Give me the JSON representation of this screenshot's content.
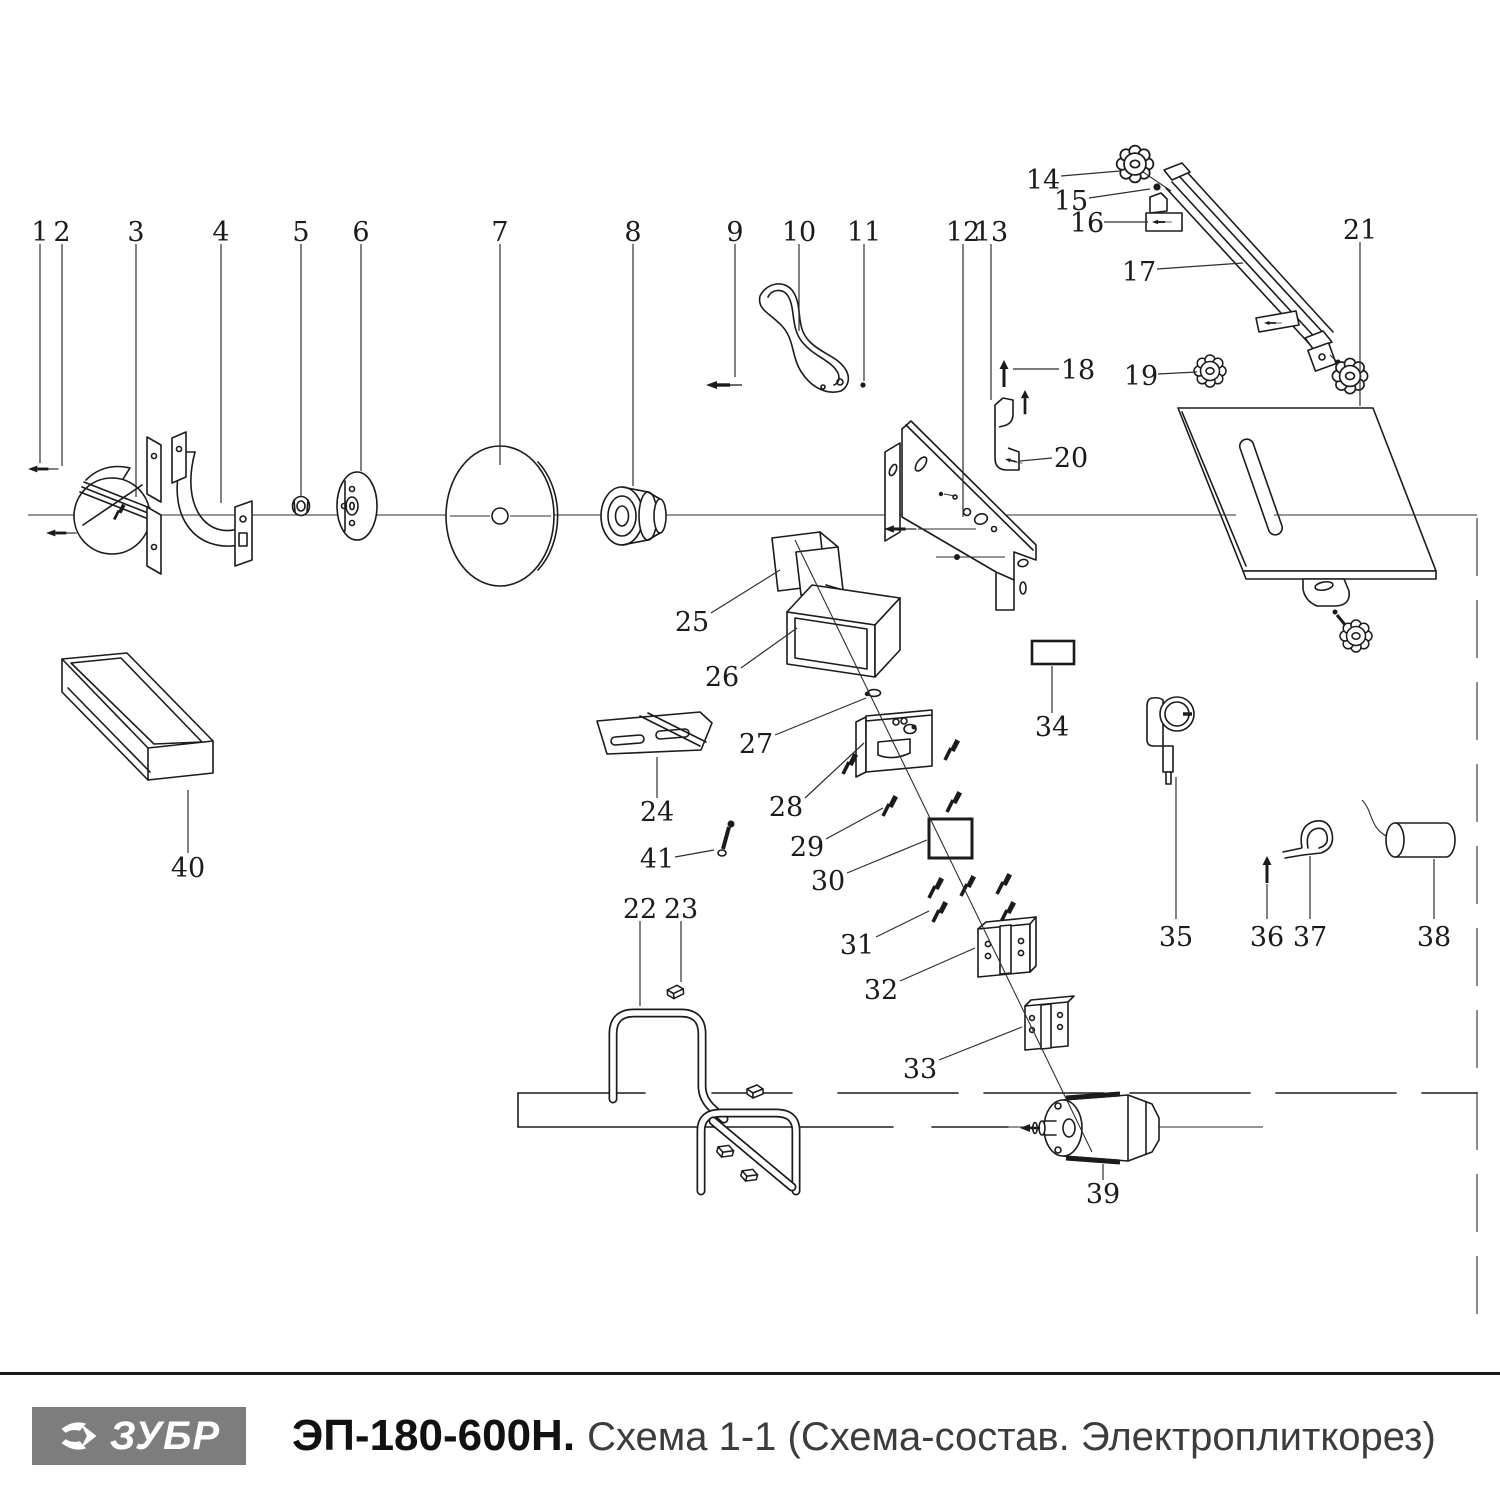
{
  "footer": {
    "logo": {
      "text": "ЗУБР",
      "bg": "#7d7d7d",
      "fg": "#ffffff"
    },
    "model": "ЭП-180-600Н.",
    "subtitle": "Схема 1-1 (Схема-состав. Электроплиткорез)"
  },
  "diagram": {
    "stroke": "#1b1b1b",
    "callouts": [
      {
        "n": "1",
        "label": [
          40,
          232
        ],
        "line": [
          40,
          244,
          40,
          463
        ]
      },
      {
        "n": "2",
        "label": [
          62,
          232
        ],
        "line": [
          62,
          244,
          62,
          466
        ]
      },
      {
        "n": "3",
        "label": [
          136,
          232
        ],
        "line": [
          136,
          244,
          136,
          497
        ]
      },
      {
        "n": "4",
        "label": [
          221,
          232
        ],
        "line": [
          221,
          244,
          221,
          503
        ]
      },
      {
        "n": "5",
        "label": [
          301,
          232
        ],
        "line": [
          301,
          244,
          301,
          496
        ]
      },
      {
        "n": "6",
        "label": [
          361,
          232
        ],
        "line": [
          361,
          244,
          361,
          471
        ]
      },
      {
        "n": "7",
        "label": [
          500,
          232
        ],
        "line": [
          500,
          244,
          500,
          465
        ]
      },
      {
        "n": "8",
        "label": [
          633,
          232
        ],
        "line": [
          633,
          244,
          633,
          486
        ]
      },
      {
        "n": "9",
        "label": [
          735,
          232
        ],
        "line": [
          735,
          244,
          735,
          377
        ]
      },
      {
        "n": "10",
        "label": [
          799,
          232
        ],
        "line": [
          799,
          244,
          799,
          331
        ]
      },
      {
        "n": "11",
        "label": [
          864,
          232
        ],
        "line": [
          864,
          244,
          864,
          381
        ]
      },
      {
        "n": "12",
        "label": [
          963,
          232
        ],
        "line": [
          963,
          244,
          963,
          517
        ]
      },
      {
        "n": "13",
        "label": [
          991,
          232
        ],
        "line": [
          991,
          244,
          991,
          400
        ]
      },
      {
        "n": "14",
        "label": [
          1043,
          180
        ],
        "line": [
          1061,
          176,
          1120,
          171
        ]
      },
      {
        "n": "15",
        "label": [
          1071,
          201
        ],
        "line": [
          1089,
          198,
          1150,
          189
        ]
      },
      {
        "n": "16",
        "label": [
          1087,
          223
        ],
        "line": [
          1104,
          222,
          1148,
          222
        ]
      },
      {
        "n": "17",
        "label": [
          1139,
          272
        ],
        "line": [
          1157,
          269,
          1243,
          263
        ]
      },
      {
        "n": "18",
        "label": [
          1078,
          370
        ],
        "line": [
          1059,
          369,
          1013,
          369
        ]
      },
      {
        "n": "19",
        "label": [
          1141,
          376
        ],
        "line": [
          1158,
          374,
          1197,
          372
        ]
      },
      {
        "n": "20",
        "label": [
          1071,
          458
        ],
        "line": [
          1052,
          458,
          1020,
          461
        ]
      },
      {
        "n": "21",
        "label": [
          1360,
          230
        ],
        "line": [
          1360,
          242,
          1360,
          406
        ]
      },
      {
        "n": "22",
        "label": [
          640,
          909
        ],
        "line": [
          640,
          921,
          640,
          1006
        ]
      },
      {
        "n": "23",
        "label": [
          681,
          909
        ],
        "line": [
          681,
          921,
          681,
          982
        ]
      },
      {
        "n": "24",
        "label": [
          657,
          812
        ],
        "line": [
          657,
          798,
          657,
          757
        ]
      },
      {
        "n": "25",
        "label": [
          692,
          622
        ],
        "line": [
          711,
          613,
          780,
          570
        ]
      },
      {
        "n": "26",
        "label": [
          722,
          677
        ],
        "line": [
          741,
          668,
          797,
          628
        ]
      },
      {
        "n": "27",
        "label": [
          756,
          744
        ],
        "line": [
          775,
          735,
          866,
          698
        ]
      },
      {
        "n": "28",
        "label": [
          786,
          807
        ],
        "line": [
          805,
          798,
          864,
          743
        ]
      },
      {
        "n": "29",
        "label": [
          807,
          847
        ],
        "line": [
          826,
          839,
          883,
          808
        ]
      },
      {
        "n": "30",
        "label": [
          828,
          881
        ],
        "line": [
          847,
          873,
          927,
          840
        ]
      },
      {
        "n": "31",
        "label": [
          857,
          945
        ],
        "line": [
          876,
          937,
          929,
          911
        ]
      },
      {
        "n": "32",
        "label": [
          881,
          990
        ],
        "line": [
          900,
          981,
          975,
          948
        ]
      },
      {
        "n": "33",
        "label": [
          920,
          1069
        ],
        "line": [
          939,
          1060,
          1022,
          1027
        ]
      },
      {
        "n": "34",
        "label": [
          1052,
          727
        ],
        "line": [
          1052,
          713,
          1052,
          666
        ]
      },
      {
        "n": "35",
        "label": [
          1176,
          937
        ],
        "line": [
          1176,
          919,
          1176,
          777
        ]
      },
      {
        "n": "36",
        "label": [
          1267,
          937
        ],
        "line": [
          1267,
          919,
          1267,
          884
        ]
      },
      {
        "n": "37",
        "label": [
          1310,
          937
        ],
        "line": [
          1310,
          919,
          1310,
          856
        ]
      },
      {
        "n": "38",
        "label": [
          1434,
          937
        ],
        "line": [
          1434,
          919,
          1434,
          859
        ]
      },
      {
        "n": "39",
        "label": [
          1103,
          1194
        ],
        "line": [
          1103,
          1180,
          1103,
          1164
        ]
      },
      {
        "n": "40",
        "label": [
          188,
          868
        ],
        "line": [
          188,
          853,
          188,
          790
        ]
      },
      {
        "n": "41",
        "label": [
          657,
          859
        ],
        "line": [
          675,
          857,
          714,
          850
        ]
      }
    ]
  }
}
